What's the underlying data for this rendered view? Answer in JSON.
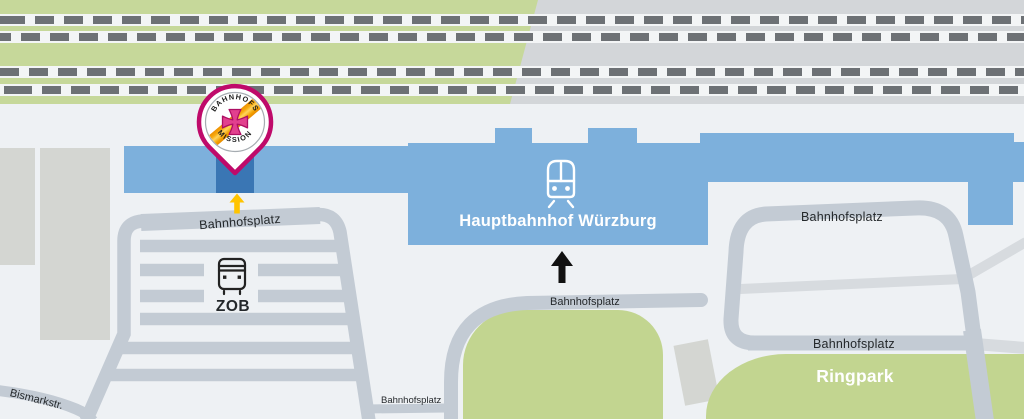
{
  "station": {
    "name": "Hauptbahnhof Würzburg"
  },
  "bus_terminal": {
    "name": "ZOB"
  },
  "park": {
    "name": "Ringpark"
  },
  "streets": {
    "zob_loop": "Bahnhofsplatz",
    "station_forecourt": "Bahnhofsplatz",
    "forecourt_south": "Bahnhofsplatz",
    "northeast": "Bahnhofsplatz",
    "east": "Bahnhofsplatz",
    "bismarck": "Bismarkstr."
  },
  "pin": {
    "arc_top": "BAHNHOFS",
    "arc_bottom": "MISSION"
  },
  "icons": {
    "train": "train-icon",
    "bus": "bus-icon",
    "north_arrow": "north-arrow-icon",
    "entrance_arrow": "entrance-arrow-icon",
    "pin": "bahnhofsmission-pin"
  },
  "colors": {
    "bg": "#eef1f4",
    "rail-green": "#c6d89a",
    "park-green": "#c2d590",
    "gray-block": "#d3d6d9",
    "rail-band": "#f3f5f6",
    "rail-dash": "#6d7175",
    "road": "#c3cbd4",
    "road-light": "#d7dbdf",
    "building": "#d4d6d2",
    "station-blue": "#7db0dc",
    "entrance-blue": "#3a76b4",
    "pin-magenta": "#bf0a6a",
    "logo-pink": "#e2408e",
    "logo-pink-dark": "#ad0e63",
    "logo-orange": "#ee9000",
    "logo-yellow": "#ffd45e",
    "label-dark": "#24282b",
    "arrow-yellow": "#ffc400"
  }
}
